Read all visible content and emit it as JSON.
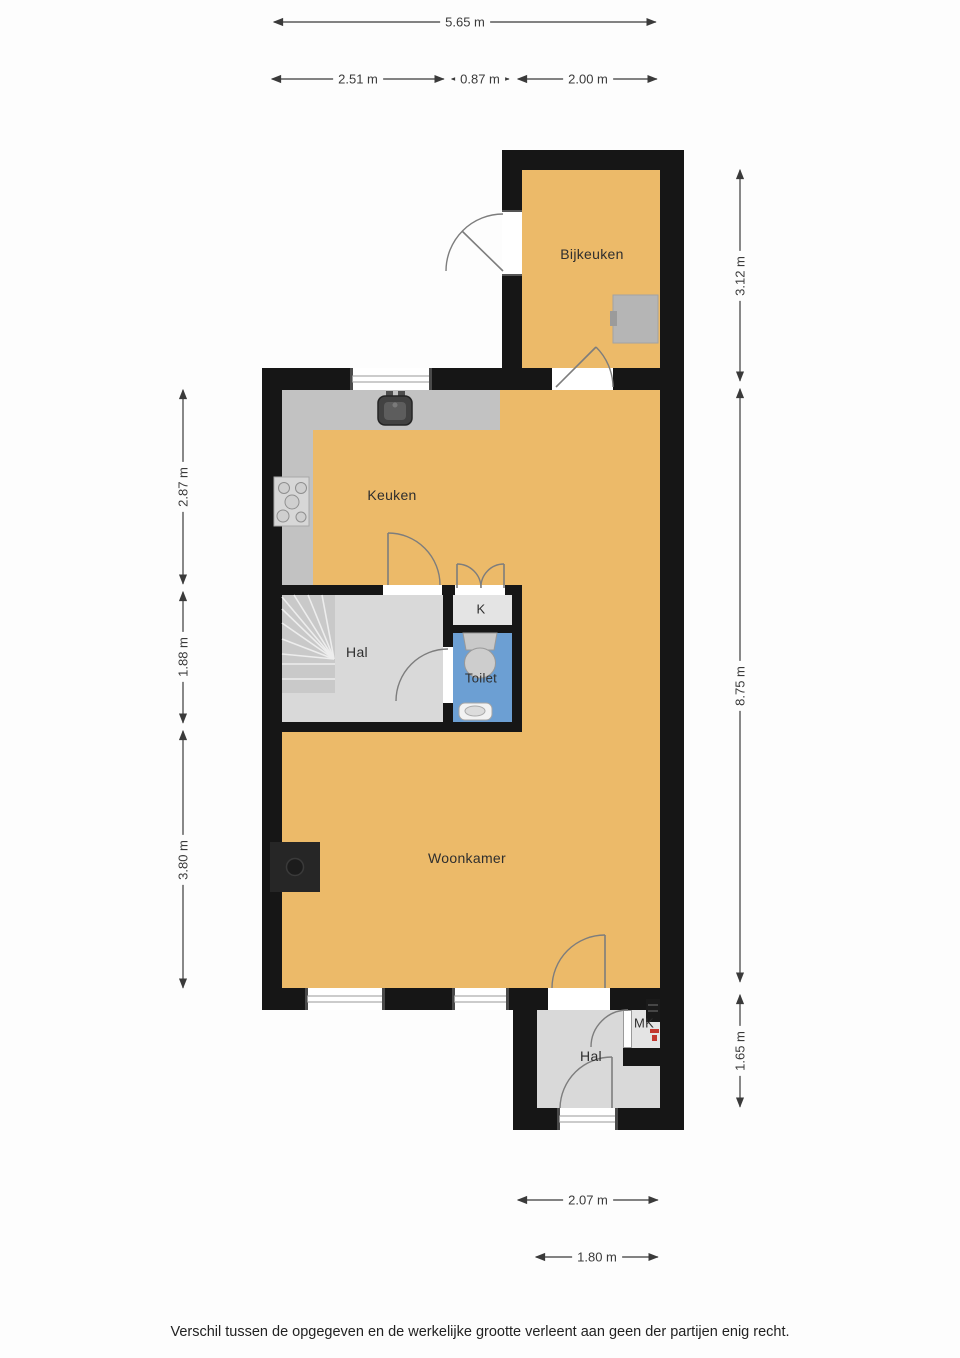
{
  "rooms": {
    "bijkeuken": "Bijkeuken",
    "keuken": "Keuken",
    "hal_mid": "Hal",
    "k_closet": "K",
    "toilet": "Toilet",
    "woonkamer": "Woonkamer",
    "mk": "MK",
    "hal_bottom": "Hal"
  },
  "dimensions": {
    "top_total": "5.65 m",
    "top_left": "2.51 m",
    "top_mid": "0.87 m",
    "top_right": "2.00 m",
    "left_upper": "2.87 m",
    "left_middle": "1.88 m",
    "left_lower": "3.80 m",
    "right_upper": "3.12 m",
    "right_middle": "8.75 m",
    "right_lower": "1.65 m",
    "bottom_upper": "2.07 m",
    "bottom_lower": "1.80 m"
  },
  "footer": {
    "disclaimer": "Verschil tussen de opgegeven en de werkelijke grootte verleent aan geen der partijen enig recht."
  },
  "colors": {
    "wall_black": "#161616",
    "floor_orange": "#ecba69",
    "floor_gray": "#d9d9d9",
    "floor_gray_light": "#e4e4e4",
    "counter_gray": "#c2c2c2",
    "stairs_gray": "#c9c9c9",
    "toilet_blue": "#6c9fd3",
    "fixture_gray": "#cbcbcb",
    "appliance_gray": "#b5b5b5",
    "door_line": "#7d7d7d",
    "dim_color": "#3a3a3a",
    "text_color": "#2e2e2e",
    "mk_red": "#c2372f"
  }
}
